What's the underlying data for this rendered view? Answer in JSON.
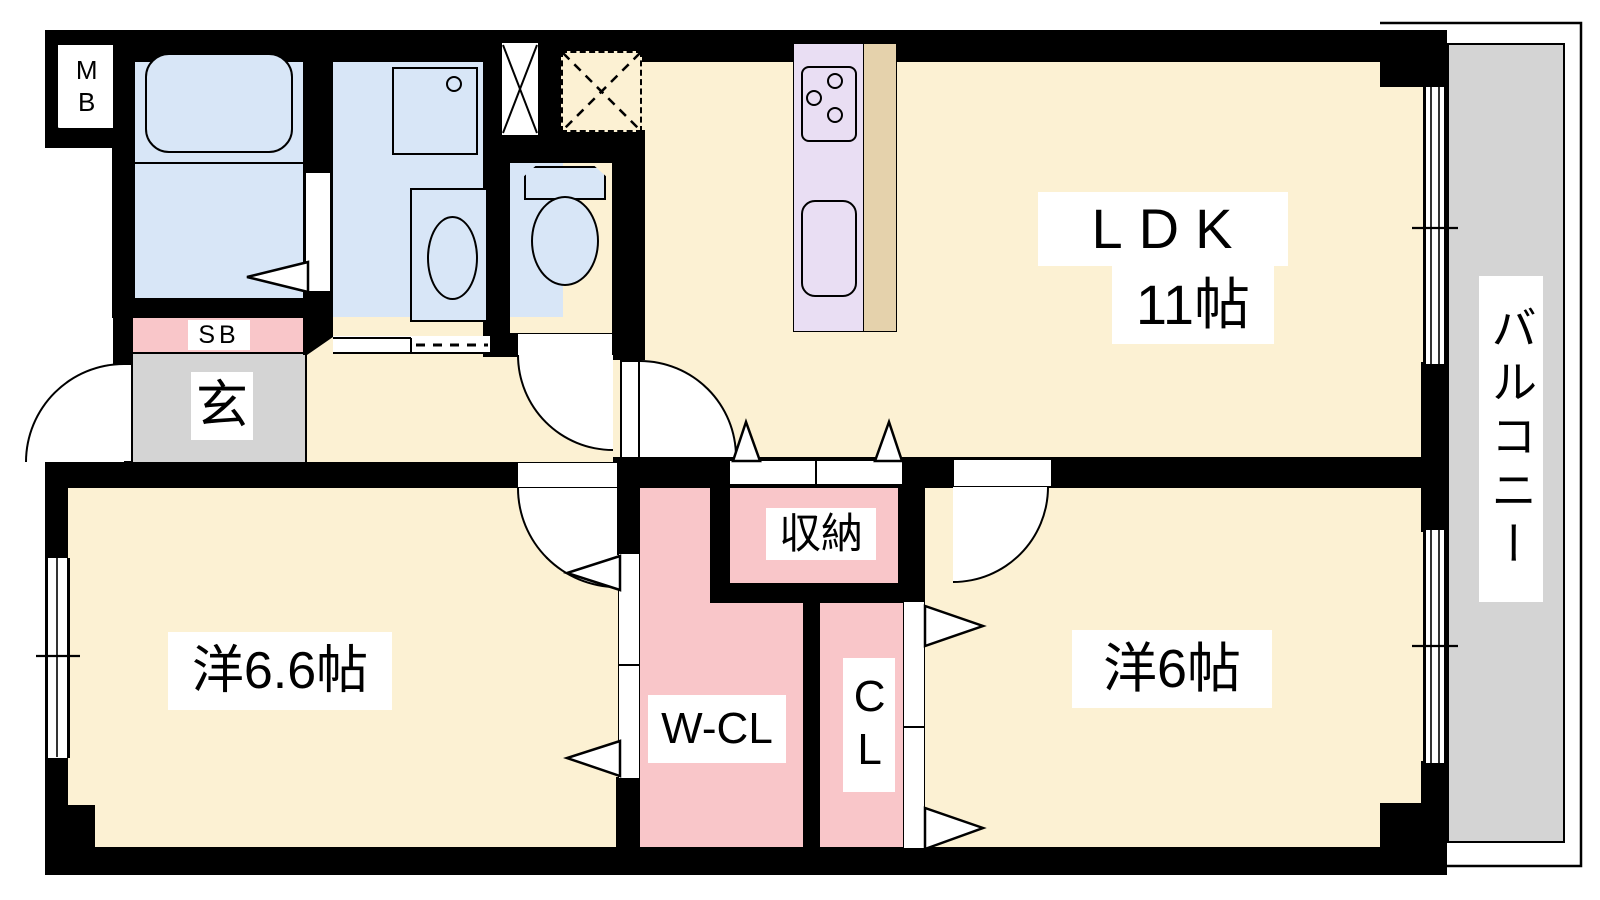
{
  "plan": {
    "title": "Japanese apartment floor plan (2LDK)",
    "labels": {
      "mb": "MB",
      "sb": "SB",
      "entrance": "玄",
      "ldk_name": "LDK",
      "ldk_size": "11帖",
      "storage": "収納",
      "walk_in_closet": "W-CL",
      "closet": "CL",
      "bedroom_left": "洋6.6帖",
      "bedroom_right": "洋6帖",
      "balcony": "バルコニー"
    },
    "colors": {
      "wall": "#000000",
      "floor": "#FCF1D3",
      "wet": "#D8E6F7",
      "pink": "#F9C6C9",
      "kitchen": "#E9DEF3",
      "tan": "#E5D2AC",
      "gray": "#D4D4D4",
      "label_bg": "#FFFFFF",
      "text": "#000000"
    },
    "fixtures": [
      "bathtub-icon",
      "washbasin-icon",
      "washing-machine-space-icon",
      "toilet-icon",
      "gas-stove-icon",
      "kitchen-sink-icon",
      "refrigerator-space-icon",
      "pipe-shaft-icon",
      "door-swing-icon",
      "folding-door-icon",
      "window-icon"
    ]
  }
}
